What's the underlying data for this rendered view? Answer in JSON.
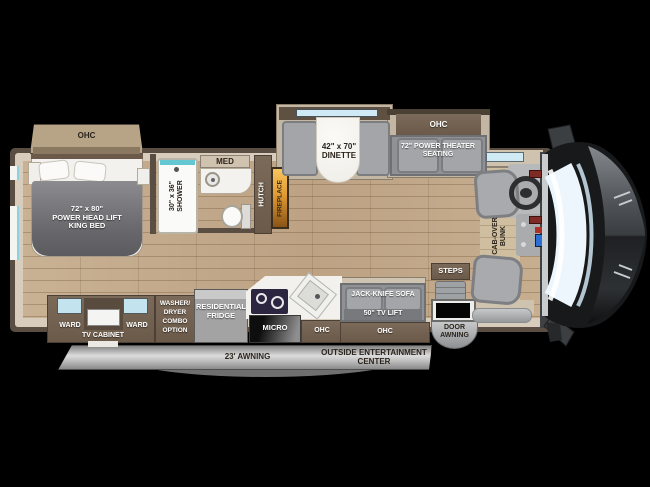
{
  "colors": {
    "background": "#000000",
    "wall_brown": "#5a4e43",
    "trim_beige": "#d8cdbc",
    "floor_wood": "#c4ac8e",
    "cabinet_brown": "#71604f",
    "slide_gray": "#9b9da0",
    "counter_white": "#f3f2ee",
    "fireplace_amber": "#e89a35",
    "awning_gray": "#c7c7c7",
    "windshield_blue": "#ecf6fc",
    "window_teal": "#bfe2ee"
  },
  "bedroom": {
    "ohc": "OHC",
    "bed_line1": "72\" x 80\"",
    "bed_line2": "POWER  HEAD LIFT",
    "bed_line3": "KING BED"
  },
  "bath": {
    "shower_line1": "30\" x 36\"",
    "shower_line2": "SHOWER",
    "med": "MED"
  },
  "hall": {
    "hutch": "HUTCH",
    "fireplace": "FIREPLACE"
  },
  "dinette": {
    "line1": "42\" x 70\"",
    "line2": "DINETTE"
  },
  "theater": {
    "ohc": "OHC",
    "line1": "72\" POWER THEATER",
    "line2": "SEATING"
  },
  "cab": {
    "bunk_line1": "CAB-OVER",
    "bunk_line2": "BUNK",
    "steps": "STEPS"
  },
  "kitchen": {
    "ward_left": "WARD",
    "tv_cabinet": "TV CABINET",
    "ward_right": "WARD",
    "washer_lines": [
      "WASHER/",
      "DRYER",
      "COMBO",
      "OPTION"
    ],
    "fridge_line1": "RESIDENTIAL",
    "fridge_line2": "FRIDGE",
    "micro": "MICRO",
    "ohc": "OHC"
  },
  "sofa": {
    "line1": "JACK-KNIFE SOFA",
    "line2": "50\" TV LIFT",
    "ohc": "OHC"
  },
  "entry": {
    "door_line1": "DOOR",
    "door_line2": "AWNING"
  },
  "exterior": {
    "awning": "23' AWNING",
    "outside_line1": "OUTSIDE ENTERTAINMENT",
    "outside_line2": "CENTER"
  }
}
